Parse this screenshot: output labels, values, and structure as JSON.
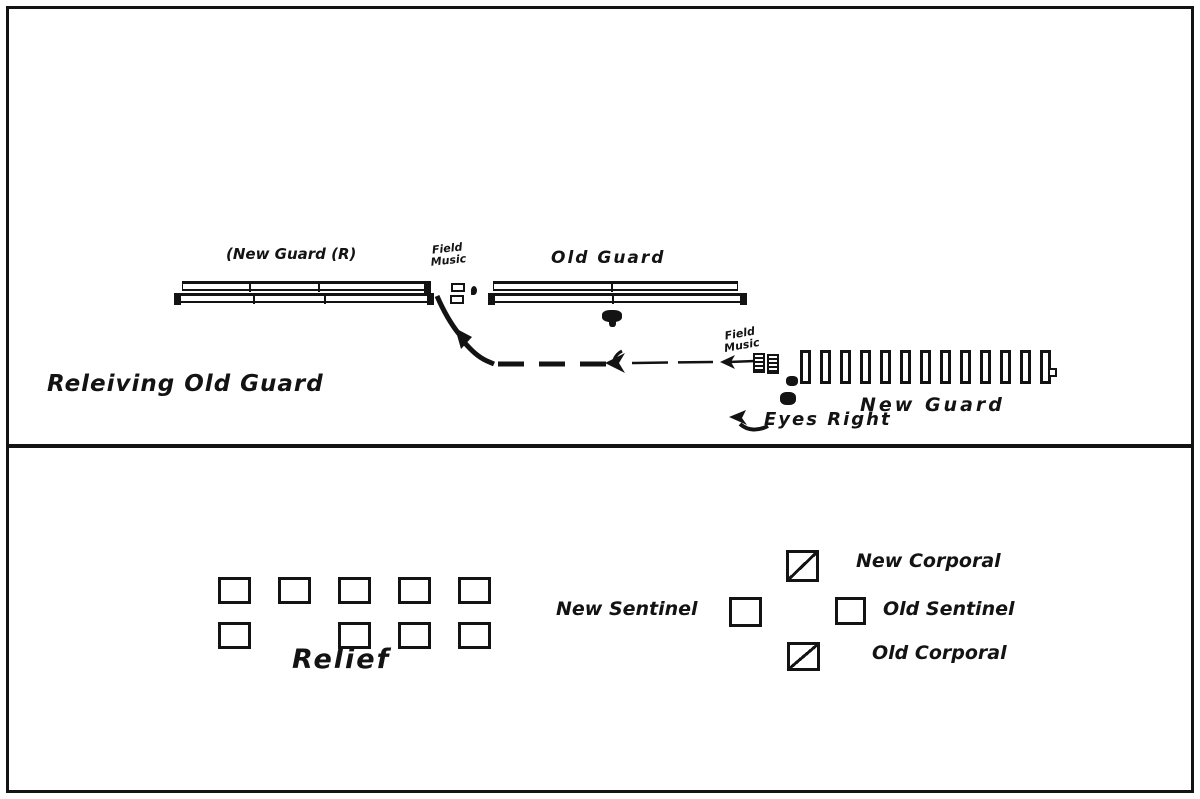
{
  "page": {
    "background": "#ffffff",
    "ink": "#131313"
  },
  "top_panel": {
    "title": "Releiving Old Guard",
    "new_guard_line_label": "(New Guard (R)",
    "field_music_top": {
      "line1": "Field",
      "line2": "Music"
    },
    "old_guard_label": "Old Guard",
    "field_music_right": {
      "line1": "Field",
      "line2": "Music"
    },
    "new_guard_column_label": "New Guard",
    "eyes_right_label": "Eyes Right",
    "new_guard_files": 13,
    "icons": [
      "rank-bar",
      "field-music-rects",
      "officer-blob",
      "march-route-arrow",
      "eyes-right-arrow"
    ]
  },
  "bottom_panel": {
    "relief_label": "Relief",
    "relief_rows": [
      [
        1,
        1,
        1,
        1,
        1
      ],
      [
        1,
        0,
        1,
        1,
        1
      ]
    ],
    "new_corporal_label": "New Corporal",
    "new_sentinel_label": "New Sentinel",
    "old_sentinel_label": "Old Sentinel",
    "old_corporal_label": "Old Corporal"
  }
}
